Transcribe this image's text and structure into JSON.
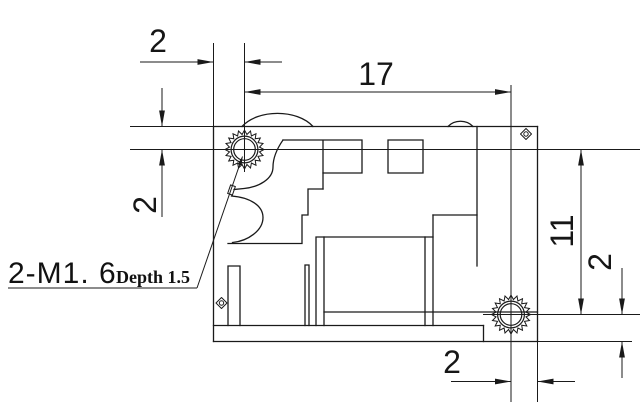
{
  "drawing": {
    "type": "engineering-dimension-drawing",
    "line_color": "#1a1a1a",
    "background": "#ffffff",
    "dimensions": {
      "top_edge_to_hole1": {
        "value": "2",
        "orientation": "horizontal",
        "position": "top-left"
      },
      "hole1_to_hole2_h": {
        "value": "17",
        "orientation": "horizontal",
        "position": "top"
      },
      "top_edge_to_center_v": {
        "value": "2",
        "orientation": "vertical",
        "position": "left"
      },
      "hole1_to_hole2_v": {
        "value": "11",
        "orientation": "vertical",
        "position": "right"
      },
      "hole2_to_bottom_v": {
        "value": "2",
        "orientation": "vertical",
        "position": "right"
      },
      "hole2_to_right_edge": {
        "value": "2",
        "orientation": "horizontal",
        "position": "bottom"
      }
    },
    "thread_label": {
      "size": "2-M1. 6",
      "depth": "Depth 1.5"
    },
    "holes": [
      {
        "name": "threaded-hole-top-left",
        "cx": 244.5,
        "cy": 149.5
      },
      {
        "name": "threaded-hole-bottom-right",
        "cx": 511,
        "cy": 314.5
      }
    ],
    "hole_style": {
      "teeth": 20,
      "r_outer": 19.5,
      "r_root": 15.2,
      "r_ring": 13.4,
      "r_bore": 10.8
    },
    "corner_markers": [
      {
        "name": "diamond-marker-top-right",
        "cx": 526,
        "cy": 134
      },
      {
        "name": "diamond-marker-left",
        "cx": 221.5,
        "cy": 303
      }
    ],
    "marker_style": {
      "half_diag": 5.5,
      "inner_r": 2.2
    }
  }
}
